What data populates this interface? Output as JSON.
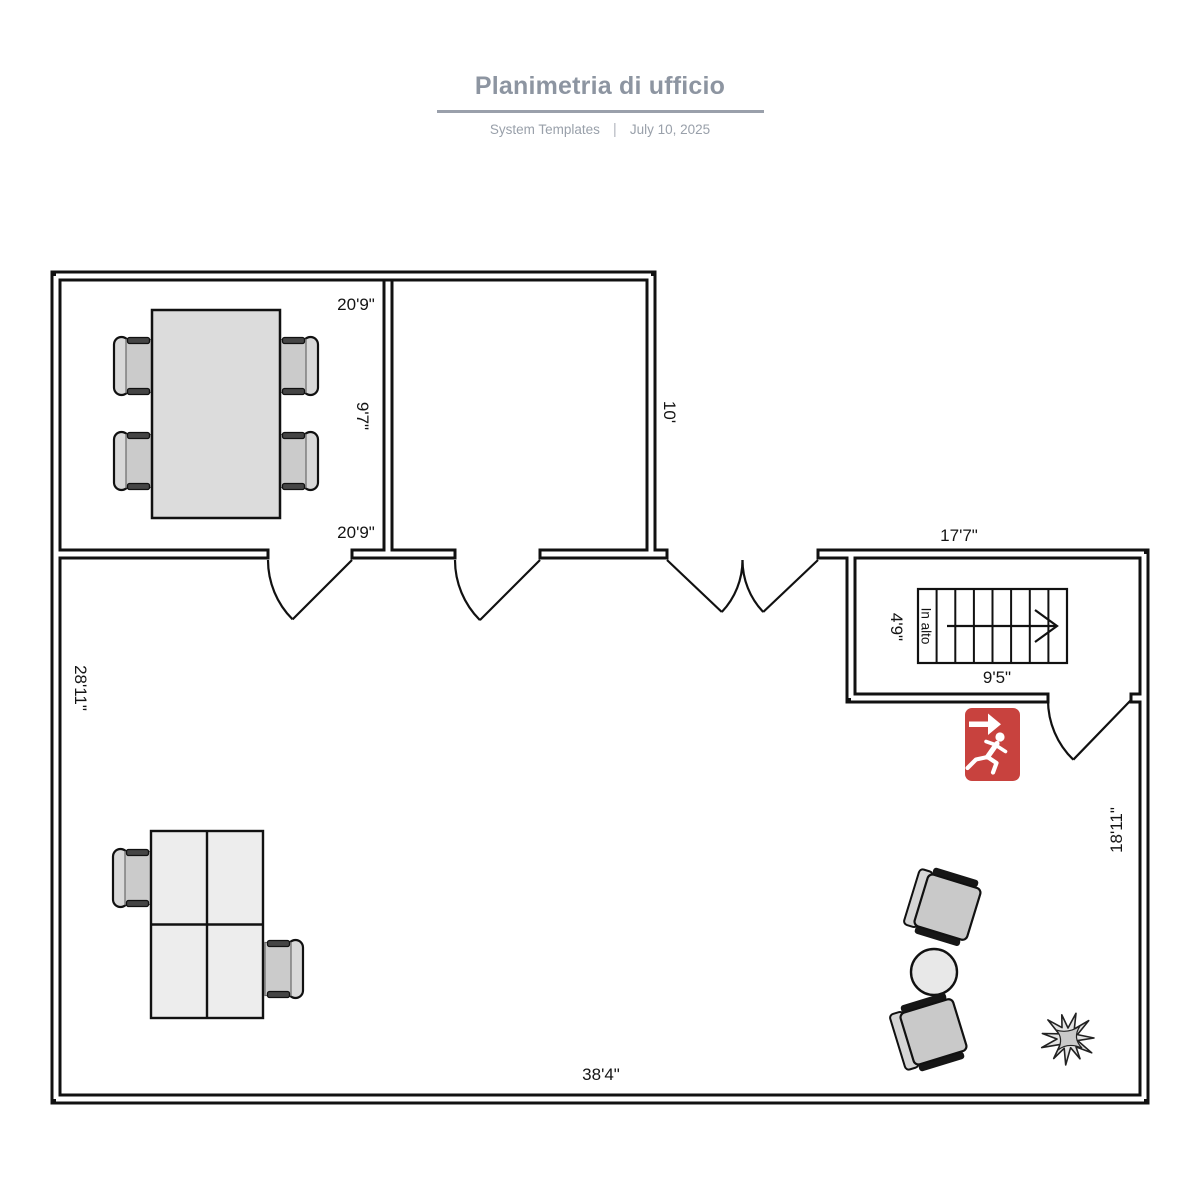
{
  "header": {
    "title": "Planimetria di ufficio",
    "template_name": "System Templates",
    "separator": "|",
    "date": "July 10, 2025"
  },
  "plan": {
    "labels": [
      {
        "id": "room1-width-top",
        "text": "20'9\""
      },
      {
        "id": "room1-height",
        "text": "9'7\""
      },
      {
        "id": "room1-width-bottom",
        "text": "20'9\""
      },
      {
        "id": "room2-height",
        "text": "10'"
      },
      {
        "id": "stairwell-width",
        "text": "17'7\""
      },
      {
        "id": "stairs-depth",
        "text": "4'9\""
      },
      {
        "id": "stairs-direction",
        "text": "In alto"
      },
      {
        "id": "stairs-width",
        "text": "9'5\""
      },
      {
        "id": "main-room-height-left",
        "text": "28'11\""
      },
      {
        "id": "main-room-height-right",
        "text": "18'11\""
      },
      {
        "id": "main-room-width-bottom",
        "text": "38'4\""
      }
    ],
    "icons": {
      "exit": "emergency-exit-runner-icon",
      "stairs_arrow": "stairs-up-direction-arrow-icon",
      "plant": "plant-icon"
    },
    "colors": {
      "wall": "#111111",
      "exit_red": "#c8423e",
      "table_fill": "#dcdcdc",
      "desk_fill": "#ededed",
      "chair_fill": "#c9c9c9",
      "title_gray": "#8d95a1"
    }
  }
}
